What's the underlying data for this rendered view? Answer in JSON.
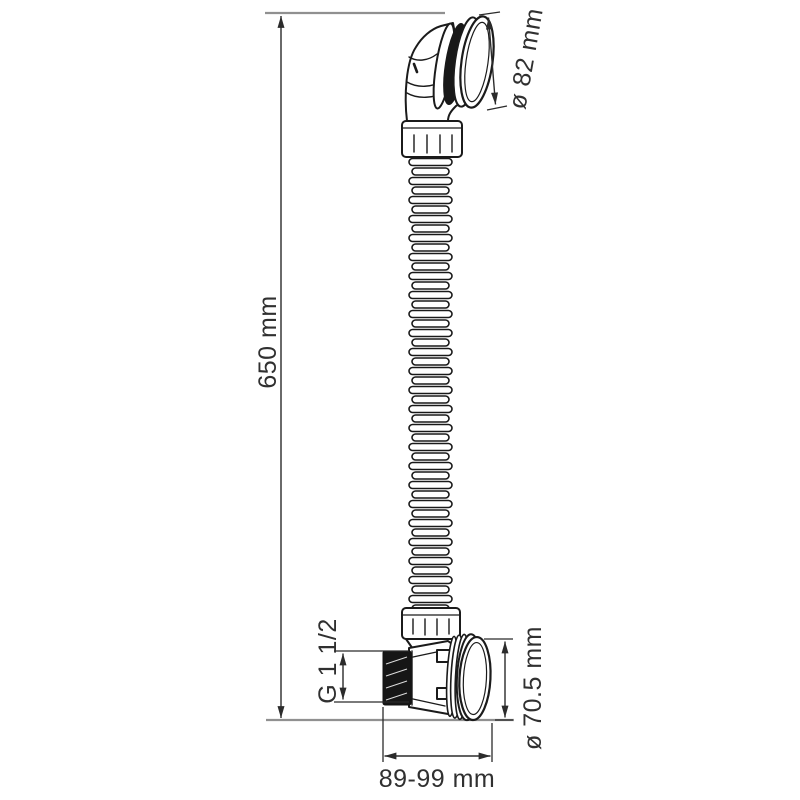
{
  "diagram": {
    "title": "Bath drain set with flexible corrugated hose — dimensional drawing",
    "background": "#ffffff",
    "colors": {
      "outline": "#1b1b1b",
      "dimension_line": "#2b2b2b",
      "extension_line": "#909090",
      "label_text": "#303030",
      "thread_fill": "#161616"
    },
    "labels": {
      "overall_height": "650 mm",
      "cap_diameter": "ø 82 mm",
      "thread_size": "G 1 1/2",
      "overflow_diameter": "ø 70.5 mm",
      "adjustable_span": "89-99 mm"
    },
    "parts": [
      "drain cap",
      "elbow fitting",
      "compression nut",
      "corrugated flexible hose",
      "tee body with external thread",
      "overflow cap"
    ]
  }
}
